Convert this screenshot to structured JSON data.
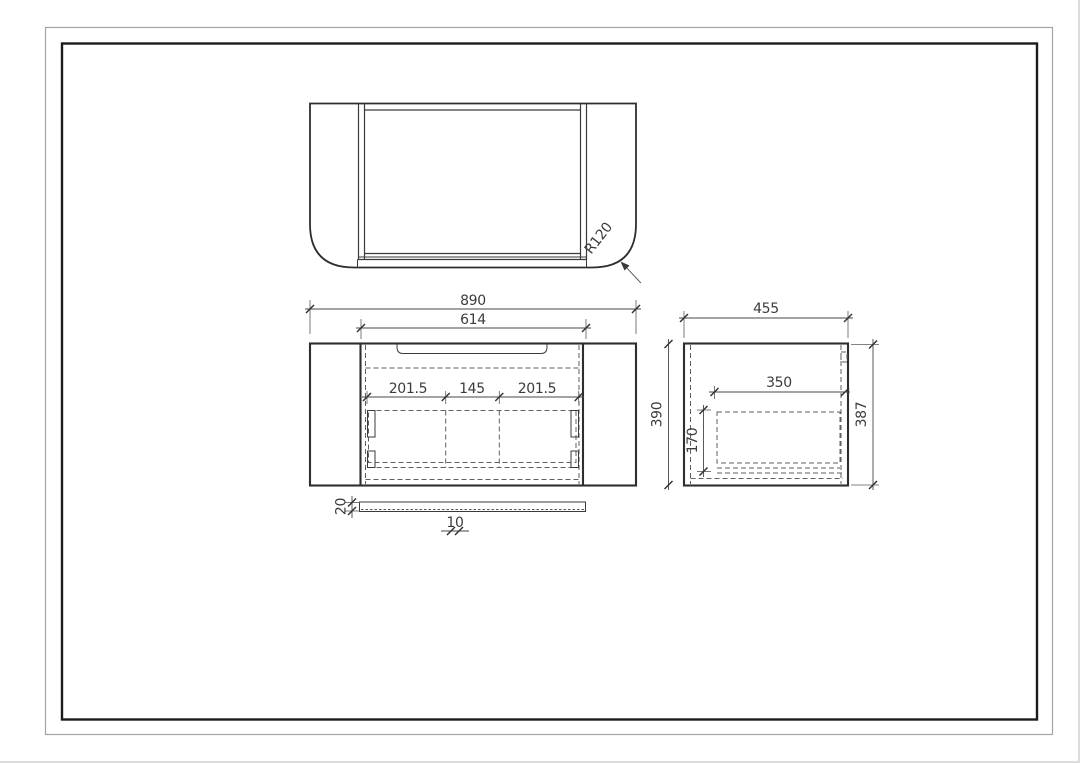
{
  "drawing": {
    "type": "technical-drawing-vanity-cabinet",
    "dims": {
      "overall_width": "890",
      "inner_width": "614",
      "drawer_section_left": "201.5",
      "drawer_section_middle": "145",
      "drawer_section_right": "201.5",
      "front_height": "390",
      "side_depth": "455",
      "drawer_depth": "350",
      "drawer_height": "170",
      "side_height": "387",
      "plinth_height": "20",
      "plinth_thickness": "10",
      "corner_radius": "R120"
    },
    "colors": {
      "background": "#ffffff",
      "outline": "#2e2e2e",
      "dashed_line": "#5f5f5f",
      "dimension_line": "#474747",
      "dimension_text": "#3c3c3c",
      "frame_outer": "#a3a3a3",
      "frame_inner": "#1c1c1c"
    }
  }
}
